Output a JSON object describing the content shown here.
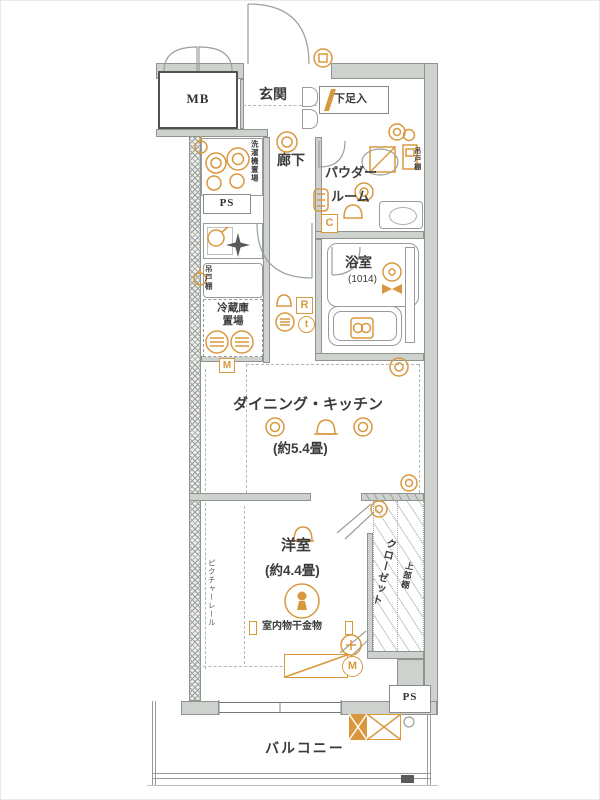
{
  "colors": {
    "accent": "#d9983e",
    "wall_fill": "#cdd2ce",
    "wall_line": "#8f948f",
    "text": "#3b3b3b"
  },
  "labels": {
    "mb": "MB",
    "genkan": "玄関",
    "shoe_cabinet": "下足入",
    "hallway": "廊下",
    "powder_line1": "パウダー",
    "powder_line2": "ルーム",
    "bath": "浴室",
    "bath_size": "(1014)",
    "washer": "洗濯機置場",
    "ps_top": "PS",
    "hanging_cabinet_kitchen": "吊戸棚",
    "hanging_cabinet_powder": "吊戸棚",
    "fridge_line1": "冷蔵庫",
    "fridge_line2": "置場",
    "dining_kitchen": "ダイニング・キッチン",
    "dining_kitchen_size": "(約5.4畳)",
    "bedroom": "洋室",
    "bedroom_size": "(約4.4畳)",
    "closet": "クローゼット",
    "upper_shelf": "上部棚",
    "picture_rail": "ピクチャーレール",
    "drying_fixture": "室内物干金物",
    "ps_bottom": "PS",
    "balcony": "バルコニー",
    "sym_c": "C",
    "sym_r": "R",
    "sym_t": "t",
    "sym_m_box": "M",
    "sym_m_circle": "M"
  }
}
